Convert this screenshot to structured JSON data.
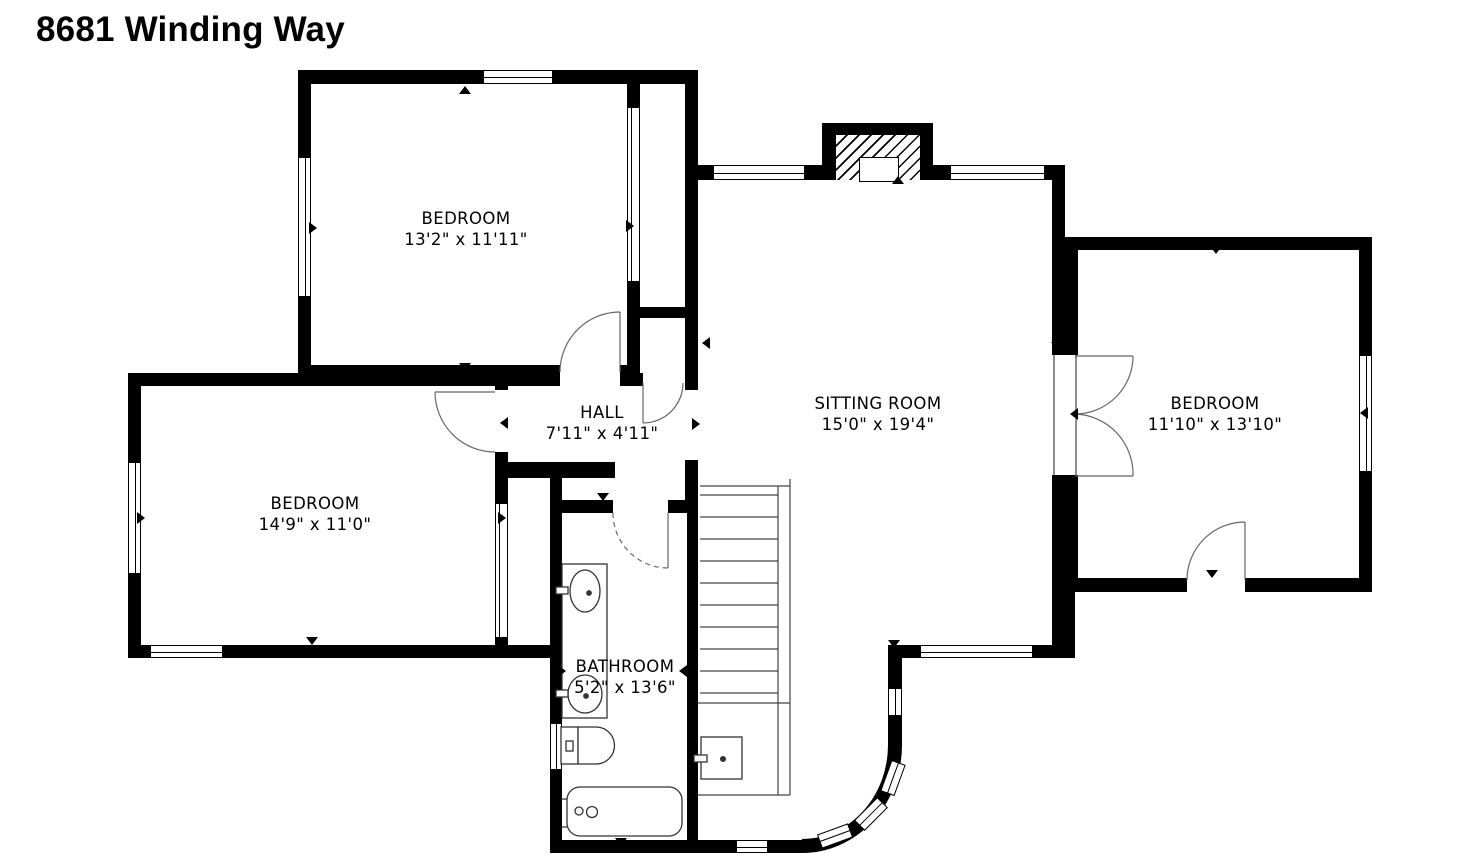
{
  "title": "8681 Winding Way",
  "rooms": {
    "bedroom_top": {
      "name": "BEDROOM",
      "dims": "13'2\" x 11'11\""
    },
    "bedroom_left": {
      "name": "BEDROOM",
      "dims": "14'9\" x 11'0\""
    },
    "bedroom_right": {
      "name": "BEDROOM",
      "dims": "11'10\" x 13'10\""
    },
    "sitting_room": {
      "name": "SITTING ROOM",
      "dims": "15'0\" x 19'4\""
    },
    "hall": {
      "name": "HALL",
      "dims": "7'11\" x 4'11\""
    },
    "bathroom": {
      "name": "BATHROOM",
      "dims": "5'2\" x 13'6\""
    }
  },
  "colors": {
    "wall": "#000000",
    "background": "#ffffff"
  },
  "fixtures": [
    "staircase",
    "fireplace-with-chimney",
    "bathtub",
    "toilet",
    "vanity-double-sink",
    "under-stair-sink",
    "curved-bay-wall",
    "door-swings",
    "windows"
  ]
}
